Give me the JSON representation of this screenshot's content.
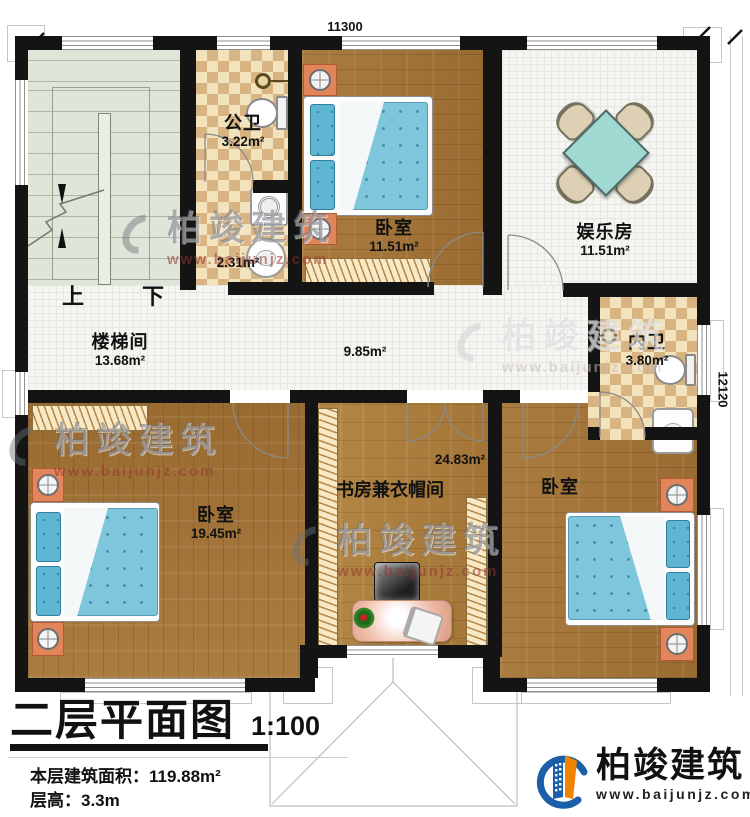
{
  "dimensions": {
    "top": "11300",
    "right": "12120"
  },
  "stairs": {
    "up": "上",
    "down": "下",
    "room": "楼梯间",
    "area": "13.68m²"
  },
  "rooms": {
    "public_bath": {
      "name": "公卫",
      "area": "3.22m²"
    },
    "laundry": {
      "area": "2.31m²"
    },
    "bedroom_top": {
      "name": "卧室",
      "area": "11.51m²"
    },
    "entertainment": {
      "name": "娱乐房",
      "area": "11.51m²"
    },
    "hallway": {
      "area": "9.85m²"
    },
    "inner_bath": {
      "name": "内卫",
      "area": "3.80m²"
    },
    "bedroom_left": {
      "name": "卧室",
      "area": "19.45m²"
    },
    "study": {
      "name": "书房兼衣帽间",
      "area": "24.83m²"
    },
    "bedroom_right": {
      "name": "卧室"
    }
  },
  "title_block": {
    "title": "二层平面图",
    "scale": "1:100",
    "floor_area_label": "本层建筑面积：",
    "floor_area_value": "119.88m²",
    "floor_height_label": "层高：",
    "floor_height_value": "3.3m"
  },
  "logo": {
    "name": "柏竣建筑",
    "url": "www.baijunjz.com"
  },
  "watermark": {
    "name": "柏竣建筑",
    "url": "www.baijunjz.com"
  },
  "colors": {
    "wall": "#141414",
    "wood": "#a2743a",
    "tile": "#f5f5f1",
    "stair": "#dee5d9",
    "checker_light": "#f2e3bd",
    "checker_dark": "#d9b483",
    "bed_blue": "#7ec6dc",
    "brand_blue": "#1a5fa8",
    "brand_orange": "#f08300"
  }
}
